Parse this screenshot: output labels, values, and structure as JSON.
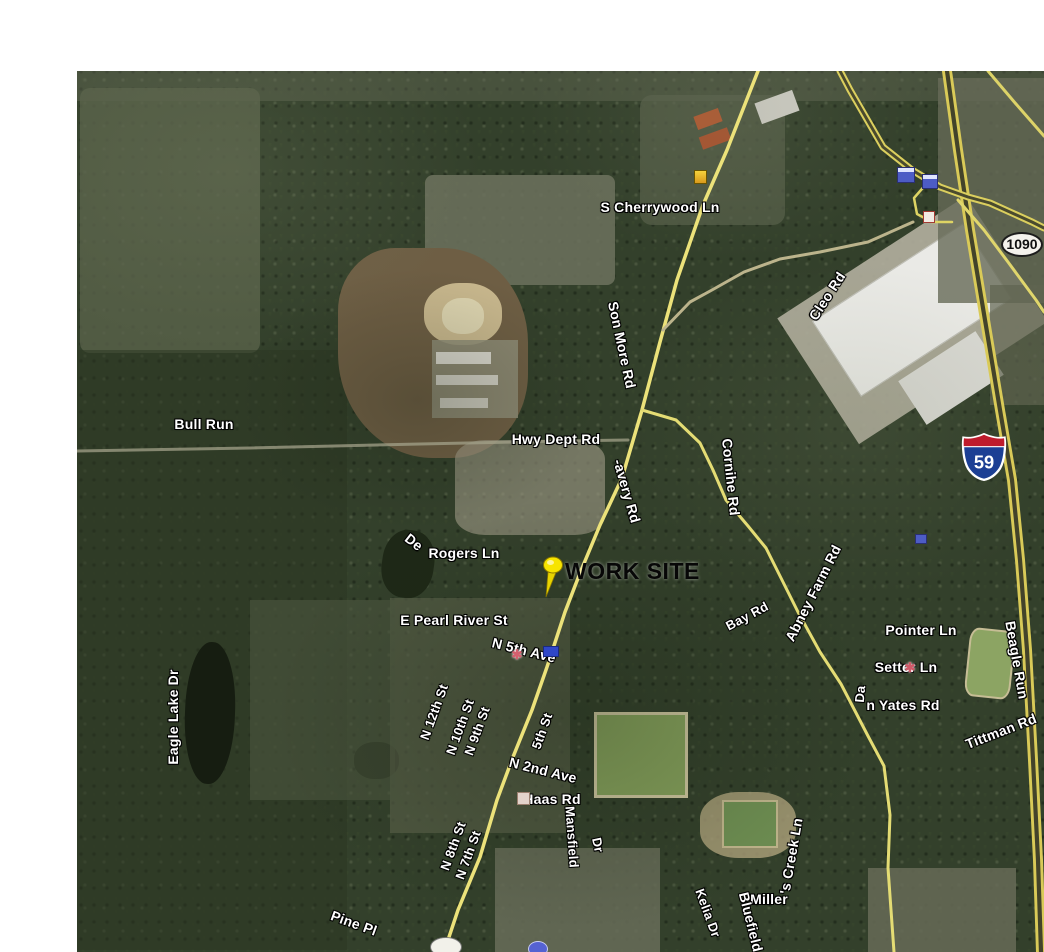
{
  "map": {
    "type": "satellite-imagery",
    "work_site": {
      "label": "WORK SITE"
    },
    "shields": [
      {
        "kind": "route-oval",
        "text": "1090"
      },
      {
        "kind": "interstate",
        "text": "59"
      }
    ],
    "road_labels": [
      {
        "t": "S Cherrywood Ln",
        "x": 660,
        "y": 207,
        "r": 0,
        "fs": 14
      },
      {
        "t": "Cleo Rd",
        "x": 827,
        "y": 296,
        "r": -57,
        "fs": 14
      },
      {
        "t": "Son More Rd",
        "x": 622,
        "y": 345,
        "r": 78,
        "fs": 14
      },
      {
        "t": "Hwy Dept Rd",
        "x": 556,
        "y": 439,
        "r": 0,
        "fs": 14
      },
      {
        "t": "Bull Run",
        "x": 204,
        "y": 424,
        "r": 0,
        "fs": 14
      },
      {
        "t": "-avery Rd",
        "x": 627,
        "y": 491,
        "r": 74,
        "fs": 14
      },
      {
        "t": "Cornihe Rd",
        "x": 731,
        "y": 477,
        "r": 84,
        "fs": 14
      },
      {
        "t": "De",
        "x": 414,
        "y": 542,
        "r": 38,
        "fs": 14
      },
      {
        "t": "Rogers Ln",
        "x": 464,
        "y": 553,
        "r": 0,
        "fs": 14
      },
      {
        "t": "E Pearl River St",
        "x": 454,
        "y": 620,
        "r": 0,
        "fs": 14
      },
      {
        "t": "N 5th Ave",
        "x": 524,
        "y": 650,
        "r": 14,
        "fs": 14
      },
      {
        "t": "N 12th St",
        "x": 434,
        "y": 712,
        "r": -70,
        "fs": 13
      },
      {
        "t": "N 10th St",
        "x": 460,
        "y": 727,
        "r": -70,
        "fs": 13
      },
      {
        "t": "N 9th St",
        "x": 477,
        "y": 731,
        "r": -70,
        "fs": 13
      },
      {
        "t": "5th St",
        "x": 542,
        "y": 731,
        "r": -70,
        "fs": 13
      },
      {
        "t": "N 2nd Ave",
        "x": 543,
        "y": 770,
        "r": 14,
        "fs": 14
      },
      {
        "t": "Haas Rd",
        "x": 552,
        "y": 799,
        "r": 0,
        "fs": 14
      },
      {
        "t": "N 8th St",
        "x": 453,
        "y": 846,
        "r": -70,
        "fs": 13
      },
      {
        "t": "N 7th St",
        "x": 468,
        "y": 855,
        "r": -70,
        "fs": 13
      },
      {
        "t": "Mansfield",
        "x": 572,
        "y": 837,
        "r": 86,
        "fs": 13
      },
      {
        "t": "Dr",
        "x": 598,
        "y": 845,
        "r": 78,
        "fs": 13
      },
      {
        "t": "Pine Pl",
        "x": 354,
        "y": 923,
        "r": 20,
        "fs": 14
      },
      {
        "t": "Miller",
        "x": 769,
        "y": 899,
        "r": 0,
        "fs": 14
      },
      {
        "t": "'s Creek Ln",
        "x": 791,
        "y": 856,
        "r": -80,
        "fs": 14
      },
      {
        "t": "Bluefield",
        "x": 751,
        "y": 922,
        "r": 76,
        "fs": 14
      },
      {
        "t": "Kelia Dr",
        "x": 708,
        "y": 913,
        "r": 70,
        "fs": 13
      },
      {
        "t": "Bay Rd",
        "x": 747,
        "y": 616,
        "r": -28,
        "fs": 13
      },
      {
        "t": "Abney Farm Rd",
        "x": 813,
        "y": 593,
        "r": -63,
        "fs": 14
      },
      {
        "t": "Pointer Ln",
        "x": 921,
        "y": 630,
        "r": 0,
        "fs": 14
      },
      {
        "t": "Setter Ln",
        "x": 906,
        "y": 667,
        "r": 0,
        "fs": 14
      },
      {
        "t": "Da",
        "x": 860,
        "y": 694,
        "r": -85,
        "fs": 13
      },
      {
        "t": "n Yates Rd",
        "x": 903,
        "y": 705,
        "r": 0,
        "fs": 14
      },
      {
        "t": "Beagle Run",
        "x": 1017,
        "y": 660,
        "r": 80,
        "fs": 14
      },
      {
        "t": "Tittman Rd",
        "x": 1001,
        "y": 731,
        "r": -21,
        "fs": 14
      },
      {
        "t": "Eagle Lake Dr",
        "x": 173,
        "y": 717,
        "r": -90,
        "fs": 14
      }
    ],
    "roads": [
      {
        "name": "main-highway",
        "w": 3.5,
        "color": "#ece27a",
        "pts": [
          [
            758,
            71
          ],
          [
            727,
            150
          ],
          [
            703,
            205
          ],
          [
            677,
            280
          ],
          [
            660,
            342
          ],
          [
            642,
            410
          ],
          [
            622,
            478
          ],
          [
            600,
            525
          ],
          [
            580,
            573
          ],
          [
            565,
            612
          ],
          [
            547,
            667
          ],
          [
            532,
            710
          ],
          [
            513,
            757
          ],
          [
            497,
            800
          ],
          [
            480,
            857
          ],
          [
            458,
            910
          ],
          [
            444,
            952
          ]
        ]
      },
      {
        "name": "branch-se-corinne",
        "w": 3,
        "color": "#e4dc74",
        "pts": [
          [
            642,
            410
          ],
          [
            676,
            420
          ],
          [
            700,
            443
          ],
          [
            713,
            470
          ],
          [
            726,
            500
          ],
          [
            748,
            526
          ],
          [
            766,
            548
          ],
          [
            781,
            578
          ],
          [
            798,
            612
          ],
          [
            820,
            652
          ],
          [
            841,
            684
          ],
          [
            868,
            736
          ],
          [
            884,
            766
          ],
          [
            890,
            815
          ],
          [
            888,
            868
          ],
          [
            894,
            952
          ]
        ]
      },
      {
        "name": "interstate-59",
        "double": true,
        "w": 10,
        "color": "#d9ca58",
        "gap": "#43432a",
        "pts": [
          [
            947,
            71
          ],
          [
            958,
            150
          ],
          [
            970,
            230
          ],
          [
            985,
            320
          ],
          [
            1000,
            410
          ],
          [
            1012,
            480
          ],
          [
            1020,
            560
          ],
          [
            1027,
            650
          ],
          [
            1033,
            760
          ],
          [
            1038,
            860
          ],
          [
            1041,
            952
          ]
        ]
      },
      {
        "name": "highway-crossing",
        "double": true,
        "w": 7,
        "color": "#dbcf5e",
        "gap": "#4a4a2e",
        "pts": [
          [
            840,
            71
          ],
          [
            850,
            90
          ],
          [
            883,
            147
          ],
          [
            912,
            170
          ],
          [
            940,
            187
          ],
          [
            968,
            197
          ],
          [
            990,
            203
          ],
          [
            1032,
            222
          ],
          [
            1044,
            228
          ]
        ]
      },
      {
        "name": "ramp-se",
        "w": 3,
        "color": "#e0d66c",
        "pts": [
          [
            958,
            200
          ],
          [
            984,
            230
          ],
          [
            1008,
            262
          ],
          [
            1036,
            300
          ],
          [
            1044,
            312
          ]
        ]
      },
      {
        "name": "ramp-loop",
        "w": 2.5,
        "color": "#ded464",
        "pts": [
          [
            928,
            182
          ],
          [
            914,
            198
          ],
          [
            917,
            214
          ],
          [
            932,
            222
          ],
          [
            952,
            222
          ]
        ]
      },
      {
        "name": "frontage-ne",
        "w": 3,
        "color": "#ddd368",
        "pts": [
          [
            988,
            71
          ],
          [
            1016,
            104
          ],
          [
            1044,
            136
          ]
        ]
      },
      {
        "name": "cleo-rd",
        "w": 3,
        "color": "#bcb48c",
        "pts": [
          [
            913,
            222
          ],
          [
            868,
            242
          ],
          [
            820,
            252
          ],
          [
            780,
            259
          ],
          [
            744,
            272
          ],
          [
            712,
            290
          ],
          [
            690,
            302
          ],
          [
            663,
            330
          ]
        ]
      },
      {
        "name": "hwy-dept-rd",
        "w": 3,
        "color": "#a3a18a",
        "opacity": 0.75,
        "pts": [
          [
            77,
            451
          ],
          [
            250,
            448
          ],
          [
            420,
            444
          ],
          [
            560,
            441
          ],
          [
            628,
            440
          ]
        ]
      }
    ],
    "icons": [
      {
        "name": "poi-yellow-icon",
        "x": 694,
        "y": 170,
        "w": 13,
        "h": 14,
        "bg": "linear-gradient(#f6d23c,#d99a1c)",
        "border": "#6b5500"
      },
      {
        "name": "poi-lodging-icon",
        "x": 897,
        "y": 167,
        "w": 18,
        "h": 16,
        "bg": "linear-gradient(#dfe4ff 0 30%,#4d5cc5 30%)",
        "border": "#2a2f72"
      },
      {
        "name": "poi-services-icon",
        "x": 922,
        "y": 174,
        "w": 16,
        "h": 15,
        "bg": "linear-gradient(#dfe4ff 0 30%,#4d5cc5 30%)",
        "border": "#2a2f72"
      },
      {
        "name": "poi-square-icon",
        "x": 923,
        "y": 211,
        "w": 12,
        "h": 12,
        "bg": "#f3ece4",
        "border": "#a33a32"
      },
      {
        "name": "poi-car-icon",
        "x": 543,
        "y": 646,
        "w": 16,
        "h": 11,
        "bg": "#2f47c8",
        "border": "#1b2a80"
      },
      {
        "name": "poi-flower-icon",
        "x": 510,
        "y": 648,
        "w": 14,
        "h": 13,
        "glyph": "✱",
        "color": "#d4606e"
      },
      {
        "name": "poi-flower-icon-2",
        "x": 903,
        "y": 661,
        "w": 14,
        "h": 13,
        "glyph": "✱",
        "color": "#cf5a68"
      },
      {
        "name": "poi-haas-icon",
        "x": 517,
        "y": 792,
        "w": 13,
        "h": 13,
        "bg": "#e3d3cb",
        "border": "#9b7f6f"
      },
      {
        "name": "poi-blue-small-icon",
        "x": 915,
        "y": 534,
        "w": 12,
        "h": 10,
        "bg": "#4d5cc5",
        "border": "#2a2f72"
      },
      {
        "name": "poi-circle-partial-icon",
        "x": 528,
        "y": 941,
        "w": 20,
        "h": 16,
        "bg": "#5562d2",
        "border": "#c8ccf0",
        "round": true
      },
      {
        "name": "shield-partial",
        "x": 430,
        "y": 937,
        "w": 32,
        "h": 20,
        "bg": "#f2f1ea",
        "border": "#777777",
        "round": true
      }
    ]
  }
}
